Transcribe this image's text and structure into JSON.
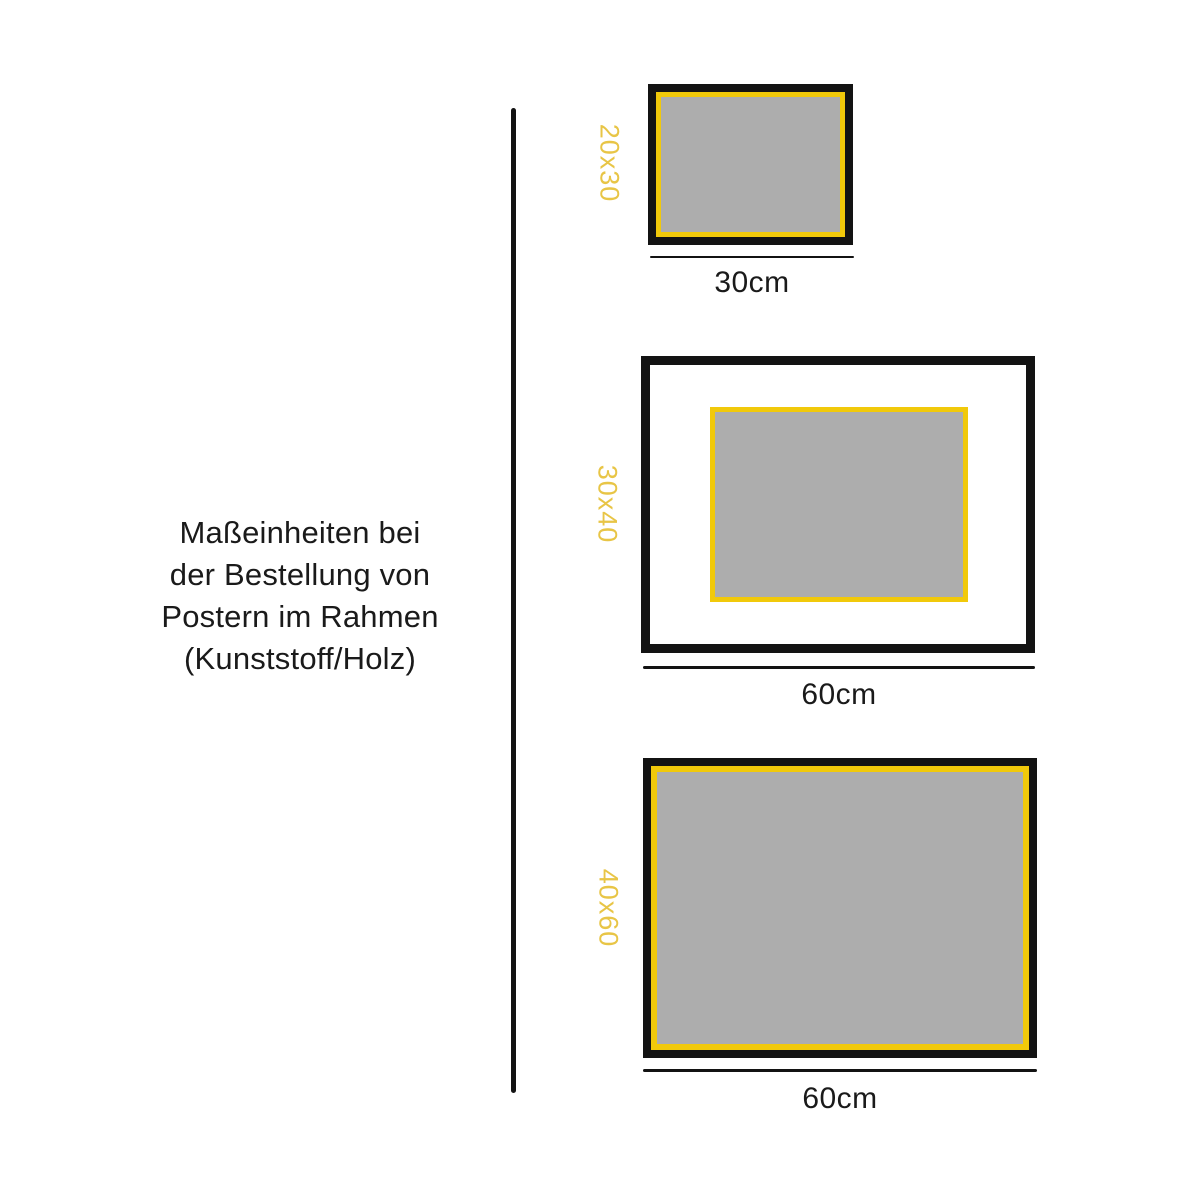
{
  "page": {
    "title": "Maßeinheiten bei\nder Bestellung von\nPostern im Rahmen\n(Kunststoff/Holz)"
  },
  "colors": {
    "background": "#ffffff",
    "ink": "#1a1a1a",
    "black": "#131313",
    "frame_yellow": "#F1C90A",
    "label_yellow": "#E8C546",
    "poster_gray": "#ADADAD"
  },
  "frames": [
    {
      "size_label": "20x30",
      "width_label": "30cm"
    },
    {
      "size_label": "30x40",
      "width_label": "60cm"
    },
    {
      "size_label": "40x60",
      "width_label": "60cm"
    }
  ]
}
